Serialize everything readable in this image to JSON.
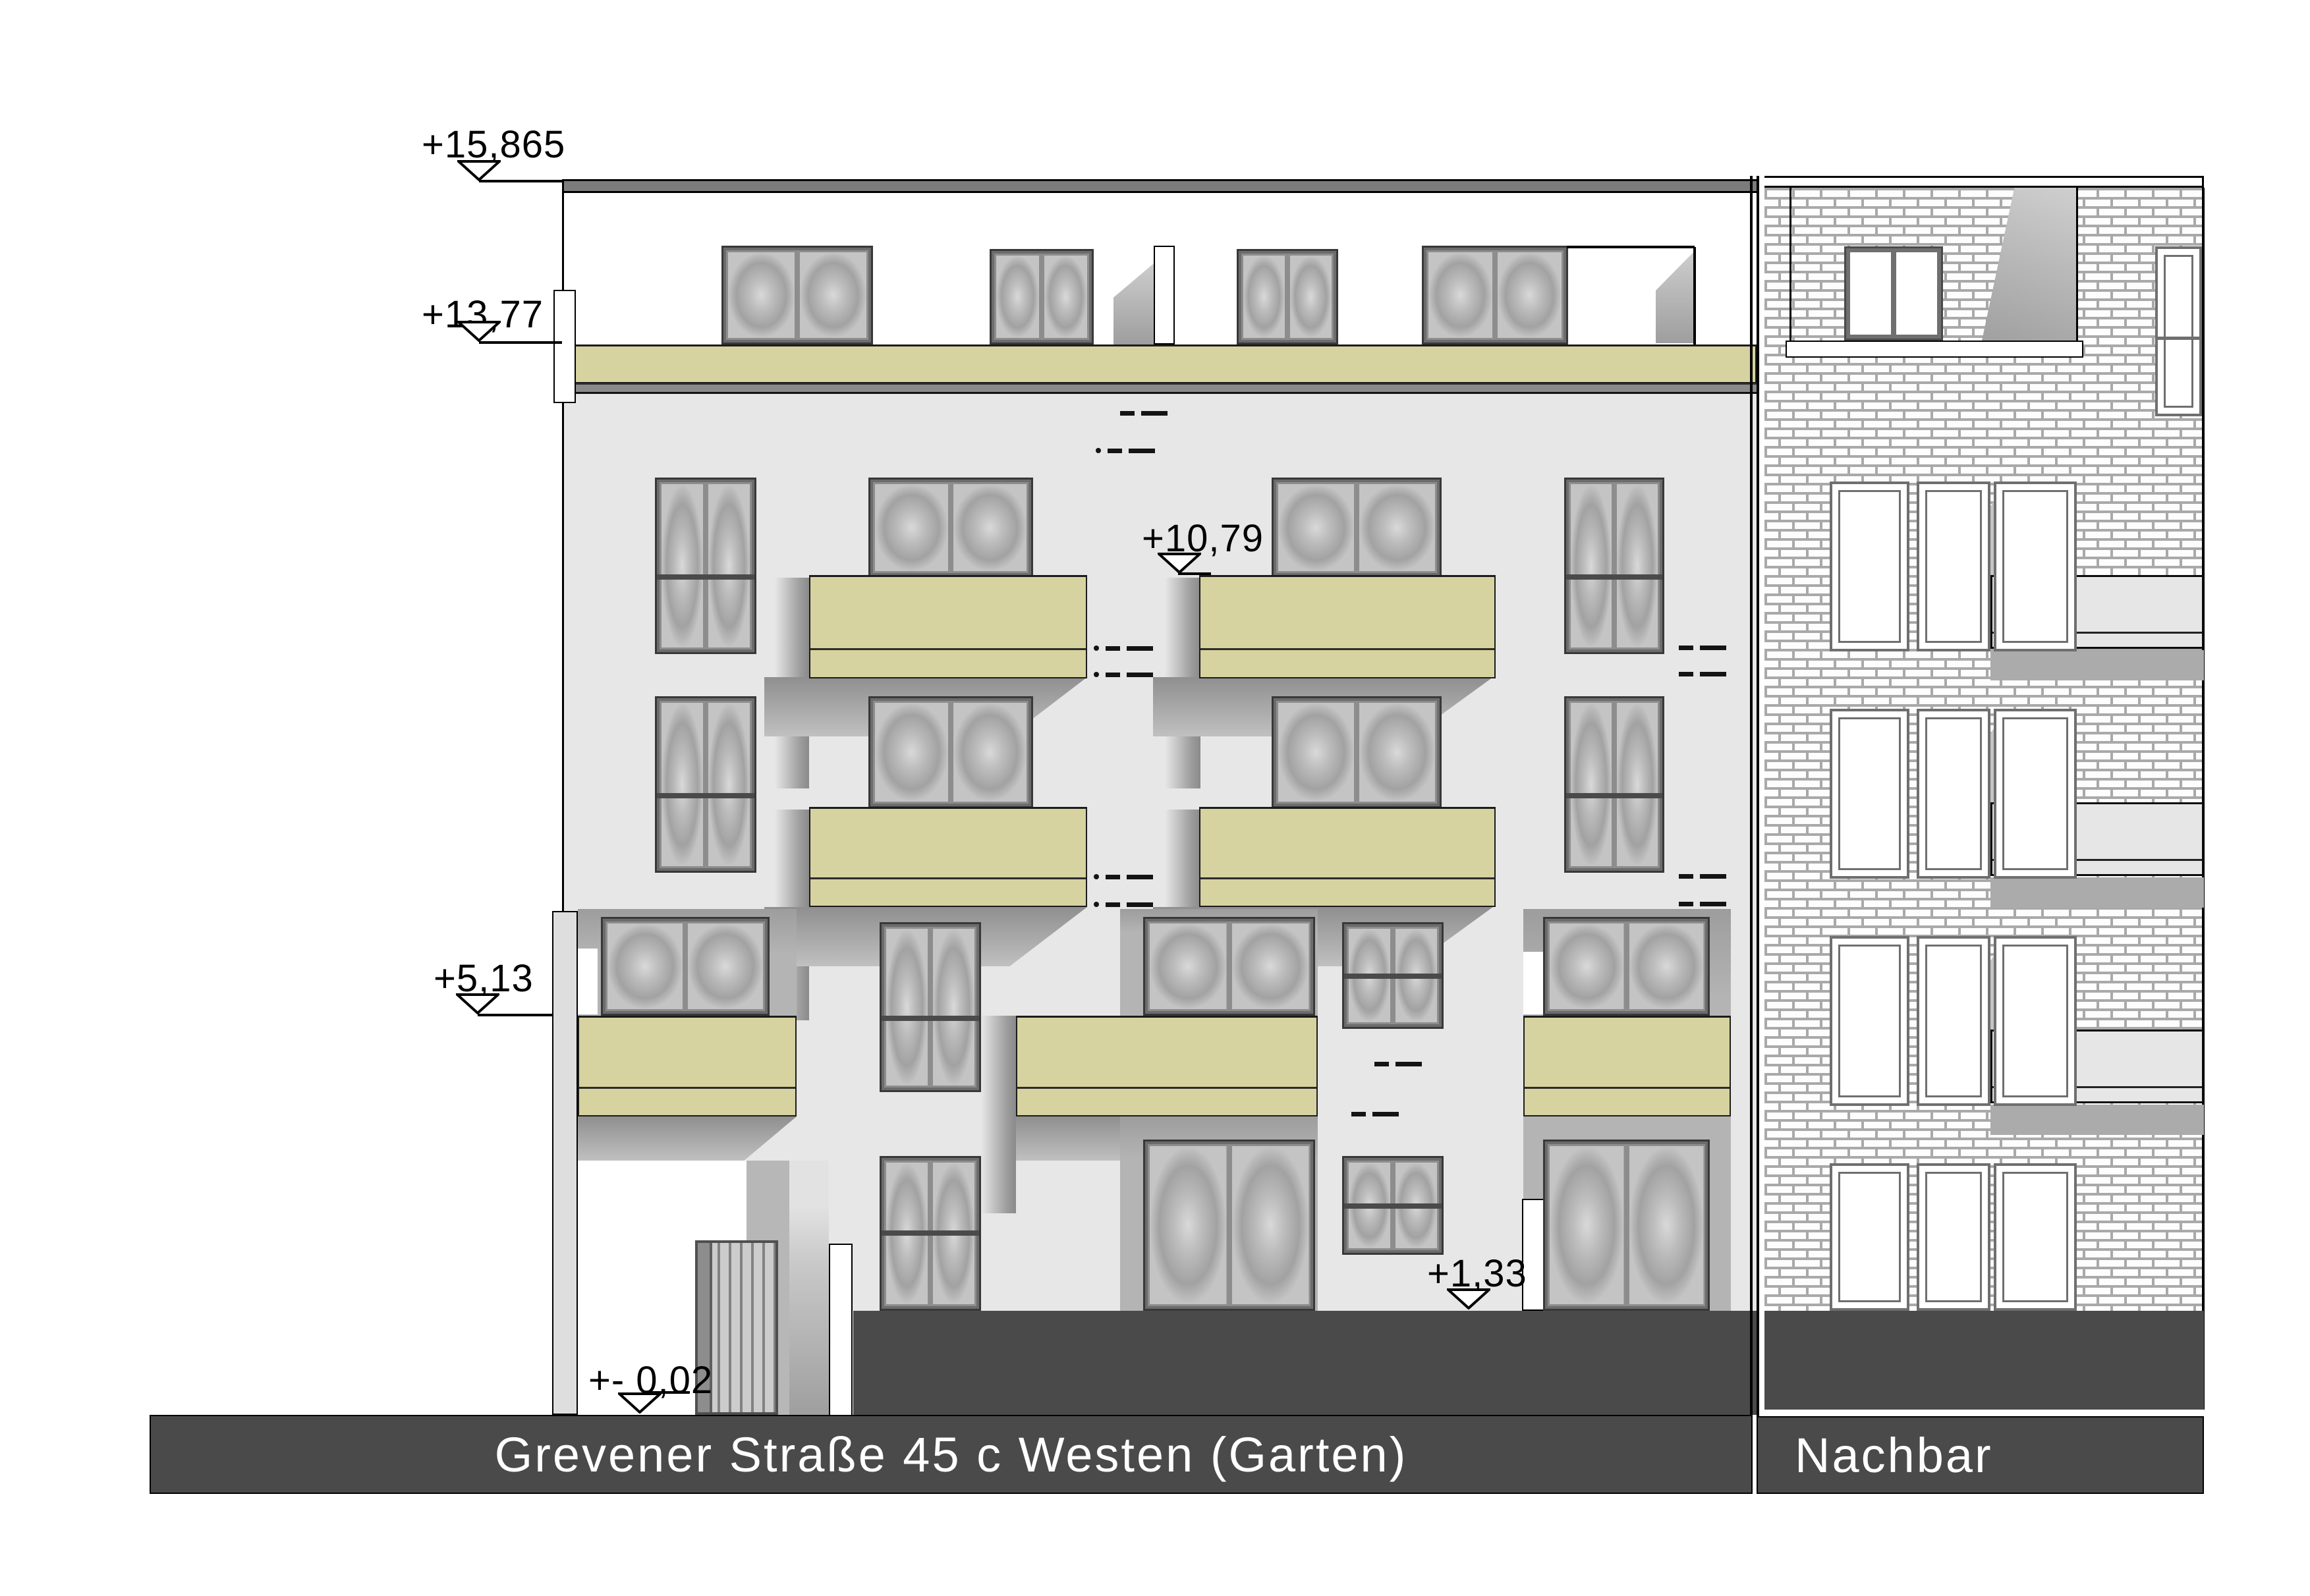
{
  "drawing": {
    "caption_main": "Grevener Straße 45 c Westen (Garten)",
    "caption_neighbor": "Nachbar"
  },
  "markers": [
    {
      "id": "roof-top",
      "label": "+15,865"
    },
    {
      "id": "roof-terrace",
      "label": "+13,77"
    },
    {
      "id": "floor-4-slab",
      "label": "+10,79"
    },
    {
      "id": "floor-2-slab",
      "label": "+5,13"
    },
    {
      "id": "garden-wall",
      "label": "+1,33"
    },
    {
      "id": "ground-level",
      "label": "+- 0,02"
    }
  ],
  "colors": {
    "facade": "#e7e7e7",
    "olive": "#d6d3a0",
    "plinth": "#4a4a4a",
    "roof": "#7c7c7c",
    "band": "#8a8a8a",
    "slab": "#e6e6e6",
    "mortar": "#a9a9a9",
    "brick": "#fdfdfd"
  }
}
